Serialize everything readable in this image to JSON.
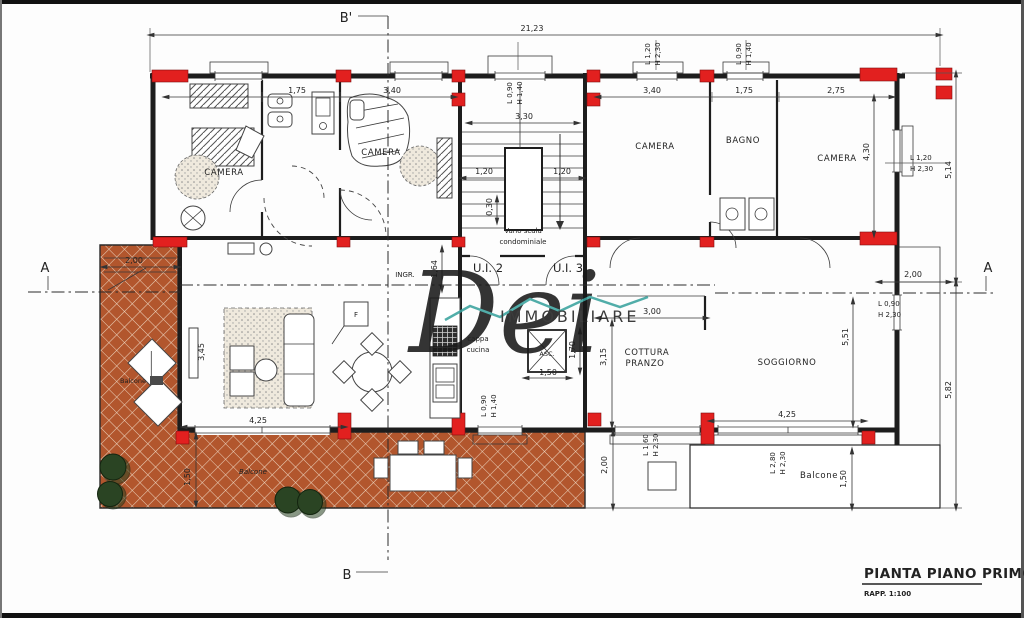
{
  "sections": {
    "top": "B'",
    "bottom": "B",
    "left": "A",
    "right": "A"
  },
  "rooms": {
    "camera1": "CAMERA",
    "camera2": "CAMERA",
    "camera3": "CAMERA",
    "bagno": "BAGNO",
    "camera4": "CAMERA",
    "vano1": "Vano scala",
    "vano2": "condominiale",
    "ui2": "U.I. 2",
    "ui3": "U.I. 3",
    "ingr": "INGR.",
    "cappa1": "cappa",
    "cappa2": "cucina",
    "asc": "ASC.",
    "cott1": "COTTURA",
    "cott2": "PRANZO",
    "sogg": "SOGGIORNO",
    "balc_left": "Balcone",
    "balc_bottom": "Balcone",
    "balc_right": "Balcone"
  },
  "dims": {
    "overall": "21,23",
    "lu1": "1,75",
    "lu2": "3,40",
    "ru1": "3,40",
    "ru2": "1,75",
    "ru3": "2,75",
    "stair_w": "3,30",
    "stair_l": "1,20",
    "stair_r": "1,20",
    "stair_s": "0,30",
    "ingr": "1,64",
    "asc_w": "1,50",
    "asc_h": "1,70",
    "cott_w": "3,00",
    "cott_h": "3,15",
    "sogg_h": "5,51",
    "sogg_w": "4,25",
    "liv_w": "4,25",
    "liv_h": "3,45",
    "balcl_w": "2,00",
    "balcl_h": "1,50",
    "r_up": "5,14",
    "r_low": "5,82",
    "r_room": "4,30",
    "r_balc": "2,00",
    "r_balc_h": "1,50",
    "cott_balc": "2,00"
  },
  "windows": {
    "stair_l1": "L 0,90",
    "stair_l2": "H 1,40",
    "w1_l1": "L 1,20",
    "w1_l2": "H 2,30",
    "w2_l1": "L 0,90",
    "w2_l2": "H 1,40",
    "kit_l1": "L 0,90",
    "kit_l2": "H 1,40",
    "d1_l1": "L 1,60",
    "d1_l2": "H 2,30",
    "d2_l1": "L 2,80",
    "d2_l2": "H 2,30",
    "r1_l1": "L 1,20",
    "r1_l2": "H 2,30",
    "r2_l1": "L 0,90",
    "r2_l2": "H 2,30"
  },
  "watermark": {
    "script": "Dei",
    "word": "IMMOBILIARE"
  },
  "titleblock": {
    "title": "PIANTA PIANO PRIMO",
    "scale": "RAPP. 1:100"
  },
  "misc": {
    "fridge": "F"
  },
  "colors": {
    "pillar": "#e2201f",
    "terracotta": "#b2562d",
    "grout": "#ecd3bd",
    "teal": "#3aa39e",
    "watermark_gray": "#9c9c9c",
    "plant": "#2a4423",
    "ink": "#2a2a2a"
  }
}
